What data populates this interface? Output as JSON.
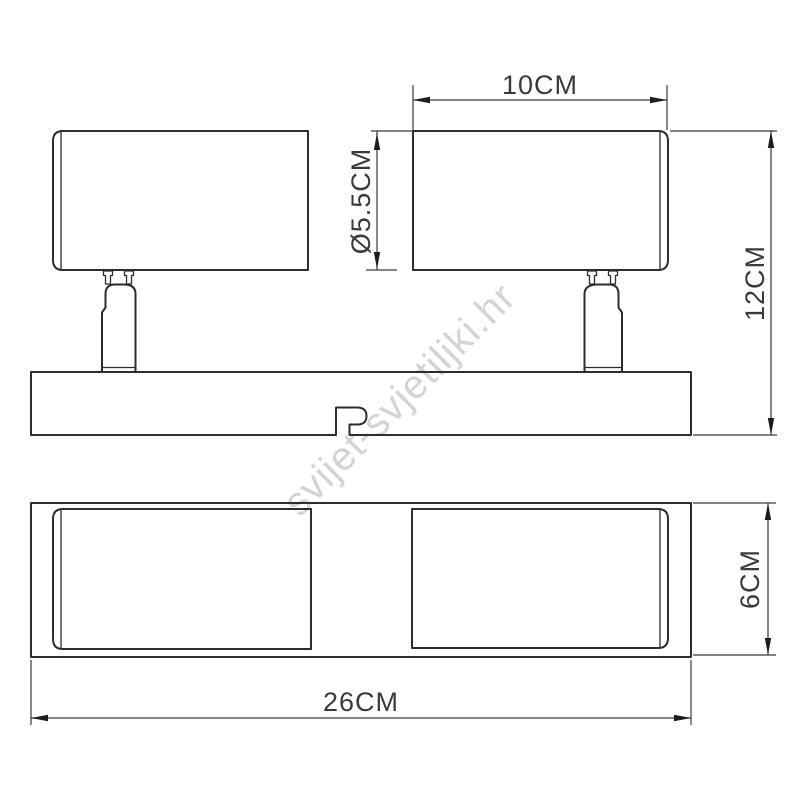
{
  "watermark": {
    "text": "svijet-svjetiljki.hr",
    "color": "#d4d4d4"
  },
  "drawing": {
    "type": "technical-dimension-diagram",
    "views": [
      "side-view",
      "bottom-view"
    ],
    "dimensions": {
      "shade_width": {
        "label": "10CM",
        "value": 10,
        "unit": "CM"
      },
      "stem_diameter": {
        "label": "Ø5.5CM",
        "value": 5.5,
        "unit": "CM"
      },
      "fixture_height": {
        "label": "12CM",
        "value": 12,
        "unit": "CM"
      },
      "base_depth": {
        "label": "6CM",
        "value": 6,
        "unit": "CM"
      },
      "base_length": {
        "label": "26CM",
        "value": 26,
        "unit": "CM"
      }
    },
    "colors": {
      "object_line": "#2d2d2d",
      "dimension_line": "#3a3a3a",
      "watermark": "#d4d4d4",
      "background": "#ffffff"
    }
  }
}
